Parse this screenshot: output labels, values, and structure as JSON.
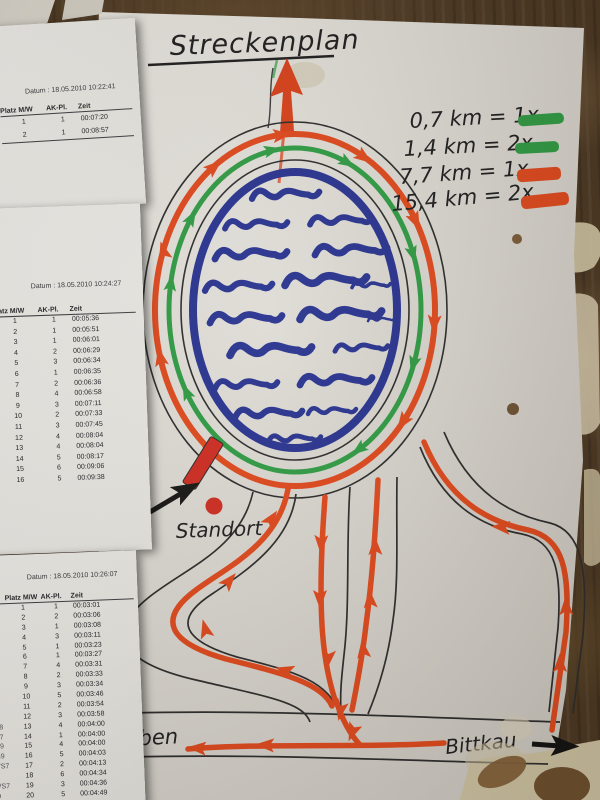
{
  "photo": {
    "board_color": "#4a3722",
    "map_sheet_color": "#e2dfd8",
    "result_sheet_color": "#f1f0ec"
  },
  "map": {
    "title": "Streckenplan",
    "legend": [
      {
        "label": "0,7 km = 1x",
        "color": "#2e9b43"
      },
      {
        "label": "1,4 km = 2x",
        "color": "#2e9b43"
      },
      {
        "label": "7,7 km = 1x",
        "color": "#e0481c"
      },
      {
        "label": "15,4 km = 2x",
        "color": "#e0481c"
      }
    ],
    "labels": {
      "standort": "Standort",
      "start_ziel_fragment_1": "t /",
      "start_ziel_fragment_2": "el",
      "town_left_fragment": "eben",
      "town_right": "Bittkau"
    },
    "colors": {
      "lake": "#27328f",
      "short_course": "#2e9b43",
      "long_course": "#e0481c",
      "road": "#2b2b2b"
    }
  },
  "result_sheets": [
    {
      "datum_label": "Datum :",
      "datum_value": "18.05.2010 10:22:41",
      "columns": [
        "Platz M/W",
        "AK-Pl.",
        "Zeit"
      ],
      "rows": [
        [
          "1",
          "1",
          "00:07:20"
        ],
        [
          "2",
          "1",
          "00:08:57"
        ]
      ]
    },
    {
      "datum_label": "Datum :",
      "datum_value": "18.05.2010 10:24:27",
      "columns": [
        "Platz M/W",
        "AK-Pl.",
        "Zeit"
      ],
      "rows": [
        [
          "1",
          "1",
          "00:05:36"
        ],
        [
          "2",
          "1",
          "00:05:51"
        ],
        [
          "3",
          "1",
          "00:06:01"
        ],
        [
          "4",
          "2",
          "00:06:29"
        ],
        [
          "5",
          "3",
          "00:06:34"
        ],
        [
          "6",
          "1",
          "00:06:35"
        ],
        [
          "7",
          "2",
          "00:06:36"
        ],
        [
          "8",
          "4",
          "00:06:58"
        ],
        [
          "9",
          "3",
          "00:07:11"
        ],
        [
          "10",
          "2",
          "00:07:33"
        ],
        [
          "11",
          "3",
          "00:07:45"
        ],
        [
          "12",
          "4",
          "00:08:04"
        ],
        [
          "13",
          "4",
          "00:08:04"
        ],
        [
          "14",
          "5",
          "00:08:17"
        ],
        [
          "15",
          "6",
          "00:09:06"
        ],
        [
          "16",
          "5",
          "00:09:38"
        ]
      ]
    },
    {
      "datum_label": "Datum :",
      "datum_value": "18.05.2010 10:26:07",
      "columns": [
        "Platz M/W",
        "AK-Pl.",
        "Zeit"
      ],
      "rows": [
        [
          "",
          "1",
          "1",
          "00:03:01"
        ],
        [
          "3",
          "2",
          "2",
          "00:03:06"
        ],
        [
          "0",
          "3",
          "1",
          "00:03:08"
        ],
        [
          "0",
          "4",
          "3",
          "00:03:11"
        ],
        [
          "9",
          "5",
          "1",
          "00:03:23"
        ],
        [
          "1",
          "6",
          "1",
          "00:03:27"
        ],
        [
          "1",
          "7",
          "4",
          "00:03:31"
        ],
        [
          "3",
          "8",
          "2",
          "00:03:33"
        ],
        [
          "9",
          "9",
          "3",
          "00:03:34"
        ],
        [
          "0",
          "10",
          "5",
          "00:03:46"
        ],
        [
          "9",
          "11",
          "2",
          "00:03:54"
        ],
        [
          "9",
          "12",
          "3",
          "00:03:58"
        ],
        [
          "V8",
          "13",
          "4",
          "00:04:00"
        ],
        [
          "S7",
          "14",
          "1",
          "00:04:00"
        ],
        [
          "V9",
          "15",
          "4",
          "00:04:00"
        ],
        [
          "N9",
          "16",
          "5",
          "00:04:03"
        ],
        [
          "VS7",
          "17",
          "2",
          "00:04:13"
        ],
        [
          "9",
          "18",
          "6",
          "00:04:34"
        ],
        [
          "VS7",
          "19",
          "3",
          "00:04:36"
        ],
        [
          "9",
          "20",
          "5",
          "00:04:49"
        ]
      ]
    }
  ]
}
